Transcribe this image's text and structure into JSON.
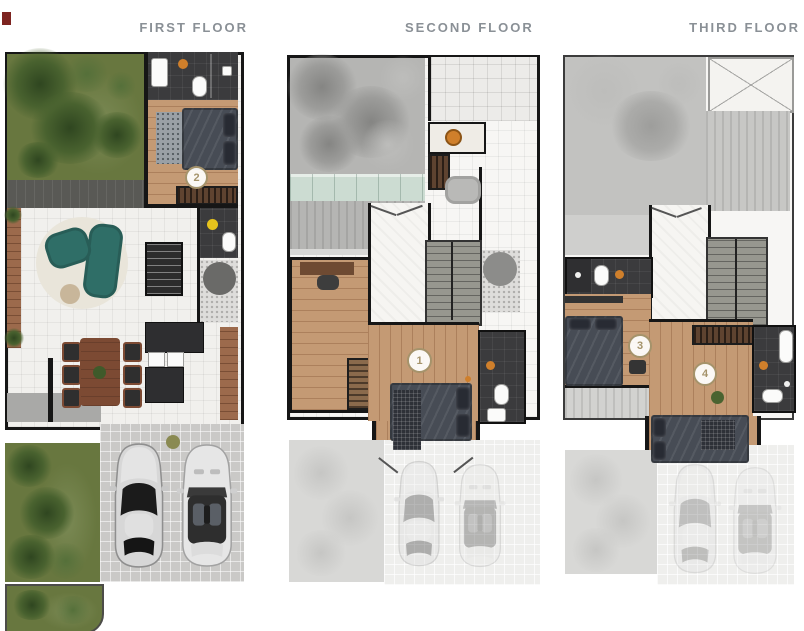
{
  "floors": [
    {
      "title": "FIRST FLOOR",
      "bedrooms": [
        {
          "label": "2"
        }
      ]
    },
    {
      "title": "SECOND FLOOR",
      "bedrooms": [
        {
          "label": "1"
        }
      ]
    },
    {
      "title": "THIRD FLOOR",
      "bedrooms": [
        {
          "label": "3"
        },
        {
          "label": "4"
        }
      ]
    }
  ],
  "palette": {
    "wall": "#161616",
    "title_gray": "#8a9096",
    "label_gold": "#a5936b",
    "wood_floor": "#c49a74",
    "deck_wood": "#9c6a4c",
    "bath_dark": "#3b3b3d",
    "sofa_teal": "#2f6e67",
    "glass_teal": "#ccdcd2",
    "accent_orange": "#cf7f2b",
    "accent_yellow": "#e6c31c",
    "accent_olive": "#8a8a52",
    "planter_red": "#7d2420",
    "grass_green": "#68773f"
  }
}
